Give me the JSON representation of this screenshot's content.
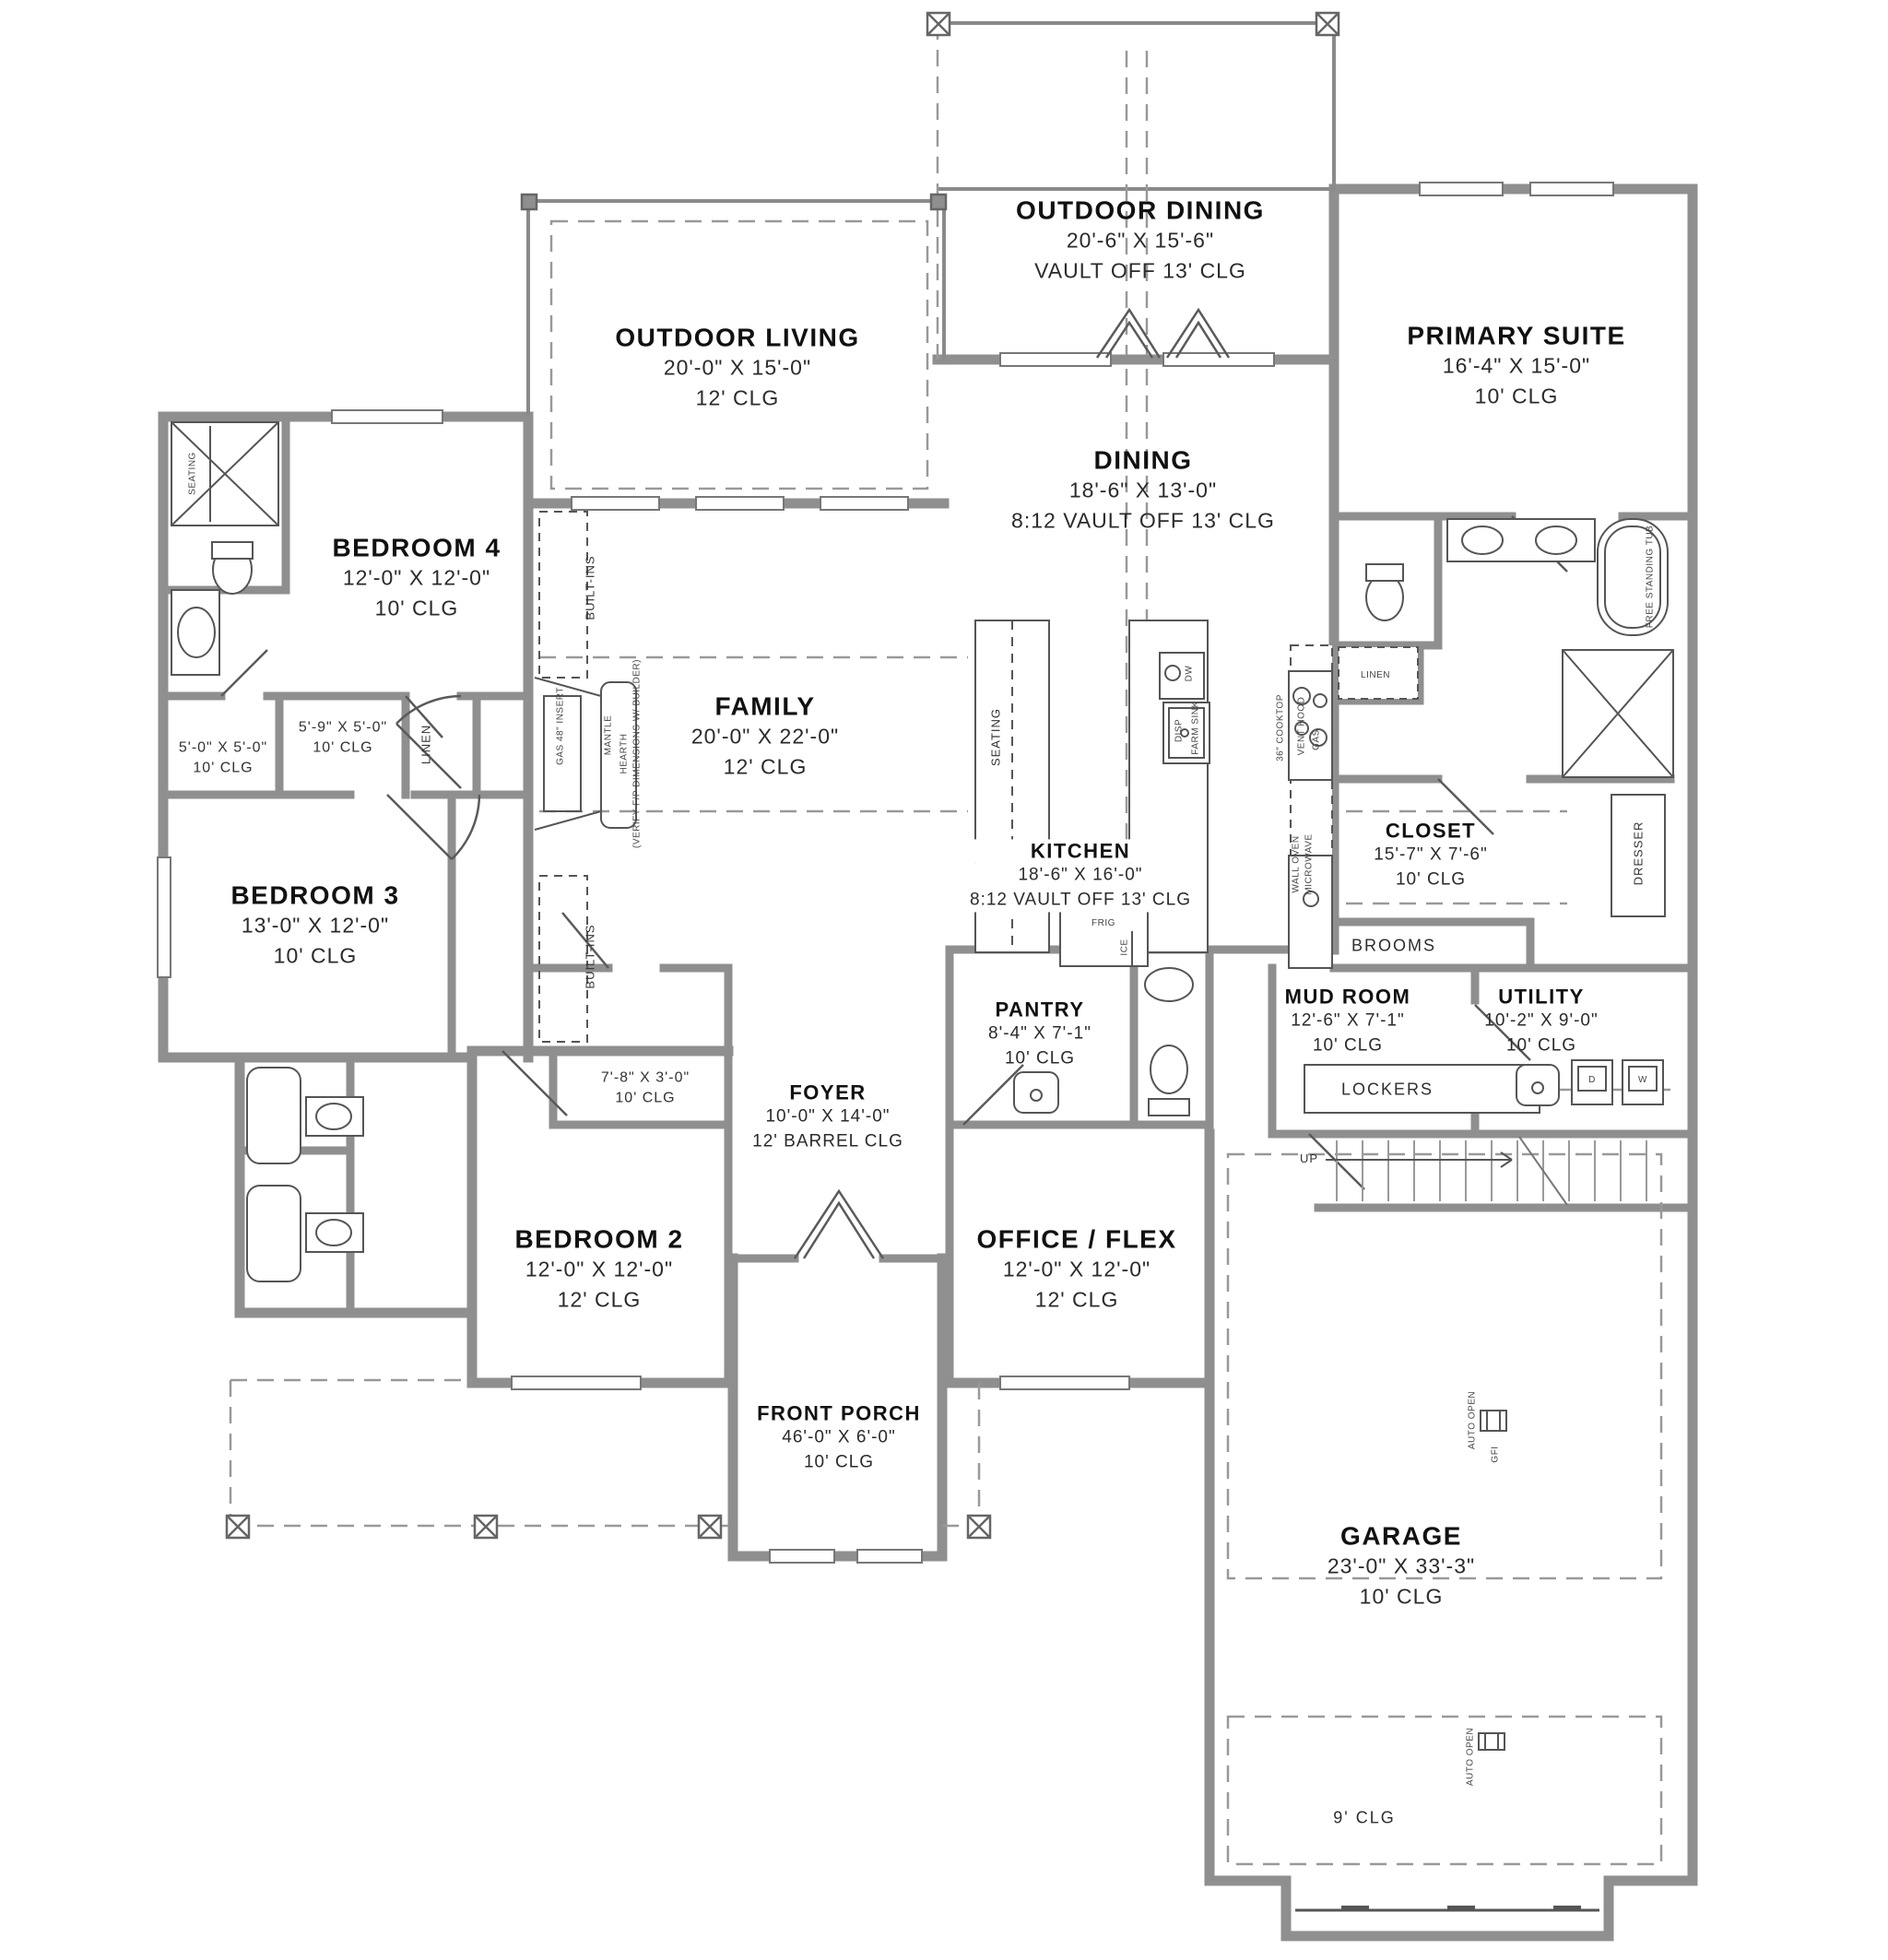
{
  "rooms": {
    "outdoor_dining": {
      "name": "OUTDOOR DINING",
      "dim": "20'-6\" X 15'-6\"",
      "clg": "VAULT OFF 13' CLG"
    },
    "outdoor_living": {
      "name": "OUTDOOR LIVING",
      "dim": "20'-0\" X 15'-0\"",
      "clg": "12' CLG"
    },
    "primary_suite": {
      "name": "PRIMARY SUITE",
      "dim": "16'-4\" X 15'-0\"",
      "clg": "10' CLG"
    },
    "dining": {
      "name": "DINING",
      "dim": "18'-6\" X 13'-0\"",
      "clg": "8:12 VAULT OFF 13' CLG"
    },
    "bedroom4": {
      "name": "BEDROOM 4",
      "dim": "12'-0\" X 12'-0\"",
      "clg": "10' CLG"
    },
    "family": {
      "name": "FAMILY",
      "dim": "20'-0\" X 22'-0\"",
      "clg": "12' CLG"
    },
    "bedroom3": {
      "name": "BEDROOM 3",
      "dim": "13'-0\" X 12'-0\"",
      "clg": "10' CLG"
    },
    "kitchen": {
      "name": "KITCHEN",
      "dim": "18'-6\" X 16'-0\"",
      "clg": "8:12 VAULT OFF 13' CLG"
    },
    "closet": {
      "name": "CLOSET",
      "dim": "15'-7\" X 7'-6\"",
      "clg": "10' CLG"
    },
    "pantry": {
      "name": "PANTRY",
      "dim": "8'-4\" X 7'-1\"",
      "clg": "10' CLG"
    },
    "mud_room": {
      "name": "MUD ROOM",
      "dim": "12'-6\" X 7'-1\"",
      "clg": "10' CLG"
    },
    "utility": {
      "name": "UTILITY",
      "dim": "10'-2\" X 9'-0\"",
      "clg": "10' CLG"
    },
    "foyer": {
      "name": "FOYER",
      "dim": "10'-0\" X 14'-0\"",
      "clg": "12' BARREL CLG"
    },
    "bedroom2": {
      "name": "BEDROOM 2",
      "dim": "12'-0\" X 12'-0\"",
      "clg": "12' CLG"
    },
    "office_flex": {
      "name": "OFFICE / FLEX",
      "dim": "12'-0\" X 12'-0\"",
      "clg": "12' CLG"
    },
    "front_porch": {
      "name": "FRONT PORCH",
      "dim": "46'-0\" X 6'-0\"",
      "clg": "10' CLG"
    },
    "garage": {
      "name": "GARAGE",
      "dim": "23'-0\" X 33'-3\"",
      "clg": "10' CLG"
    },
    "bath_closet": {
      "dim": "5'-0\" X 5'-0\"",
      "clg": "10' CLG"
    },
    "water_closet": {
      "dim": "5'-9\" X 5'-0\"",
      "clg": "10' CLG"
    },
    "coat_closet": {
      "dim": "7'-8\" X 3'-0\"",
      "clg": "10' CLG"
    }
  },
  "labels": {
    "linen": "LINEN",
    "built_ins": "BUILT-INS",
    "seating": "SEATING",
    "brooms": "BROOMS",
    "dresser": "DRESSER",
    "lockers": "LOCKERS",
    "up": "UP",
    "gfi": "GFI",
    "auto_open": "AUTO OPEN",
    "garage_rear_clg": "9' CLG",
    "frig": "FRIG",
    "ice": "ICE",
    "dw": "DW",
    "disp": "DISP",
    "farm_sink": "FARM SINK",
    "cooktop": "36\" COOKTOP",
    "vent_hood": "VENT HOOD",
    "gas": "GAS",
    "wall_oven": "WALL OVEN",
    "microwave": "MICROWAVE",
    "free_standing_tub": "FREE STANDING TUB",
    "mantle": "MANTLE",
    "gas_insert": "GAS 48\" INSERT",
    "hearth": "HEARTH",
    "hearth_note": "(VERIFY F/P DIMENSIONS W/ BUILDER)",
    "dryer": "D",
    "washer": "W"
  }
}
